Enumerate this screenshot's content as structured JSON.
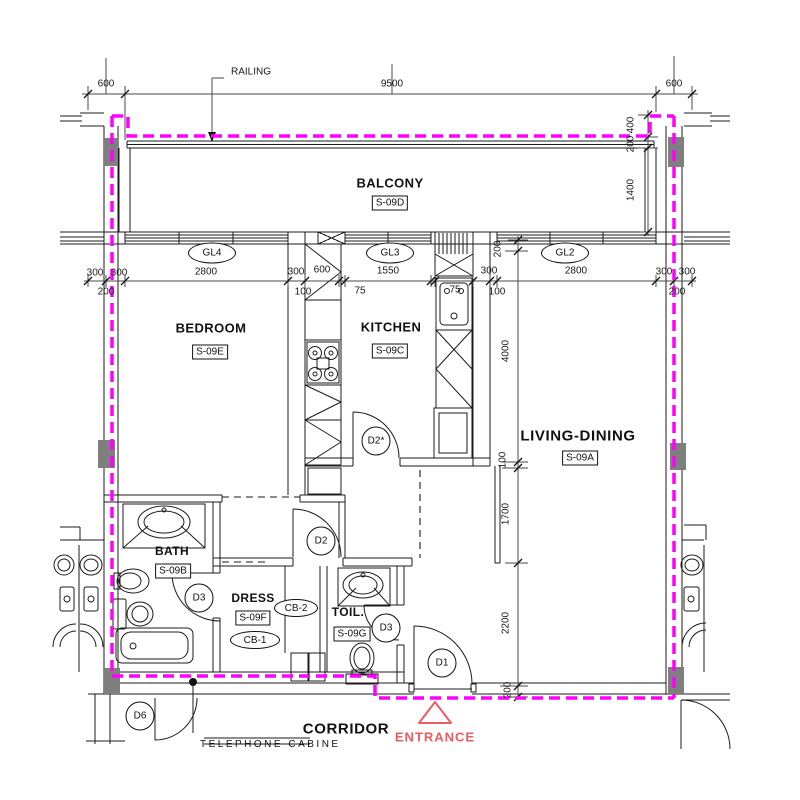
{
  "labels": {
    "railing": "RAILING",
    "balcony": "BALCONY",
    "bedroom": "BEDROOM",
    "kitchen": "KITCHEN",
    "living_dining": "LIVING-DINING",
    "bath": "BATH",
    "dress": "DRESS",
    "toilet": "TOIL.",
    "corridor": "CORRIDOR",
    "entrance": "ENTRANCE",
    "telephone_cabinet": "TELEPHONE CABINET"
  },
  "room_tags": {
    "balcony": "S-09D",
    "bedroom": "S-09E",
    "kitchen": "S-09C",
    "living_dining": "S-09A",
    "bath": "S-09B",
    "dress": "S-09F",
    "toilet": "S-09G"
  },
  "window_tags": {
    "gl4": "GL4",
    "gl3": "GL3",
    "gl2": "GL2"
  },
  "cabinet_tags": {
    "cb1": "CB-1",
    "cb2": "CB-2"
  },
  "door_tags": {
    "d1": "D1",
    "d2": "D2",
    "d2_star": "D2*",
    "d3_bath": "D3",
    "d3_toilet": "D3",
    "d6": "D6"
  },
  "dims": {
    "top": [
      "600",
      "9500",
      "600"
    ],
    "row_upper": [
      "300",
      "300",
      "2800",
      "300",
      "600",
      "1550",
      "300",
      "2800",
      "300",
      "300"
    ],
    "row_lower": [
      "200",
      "100",
      "75",
      "75",
      "100",
      "200"
    ],
    "left_chain": [
      "200",
      "4000",
      "100",
      "1700",
      "2200",
      "200"
    ],
    "balcony_chain": [
      "400",
      "200",
      "1400"
    ]
  },
  "colors": {
    "boundary": "#FF00FF",
    "entrance": "#EE5B64",
    "wall": "#1b1b1b",
    "column": "#7F7F7F"
  }
}
